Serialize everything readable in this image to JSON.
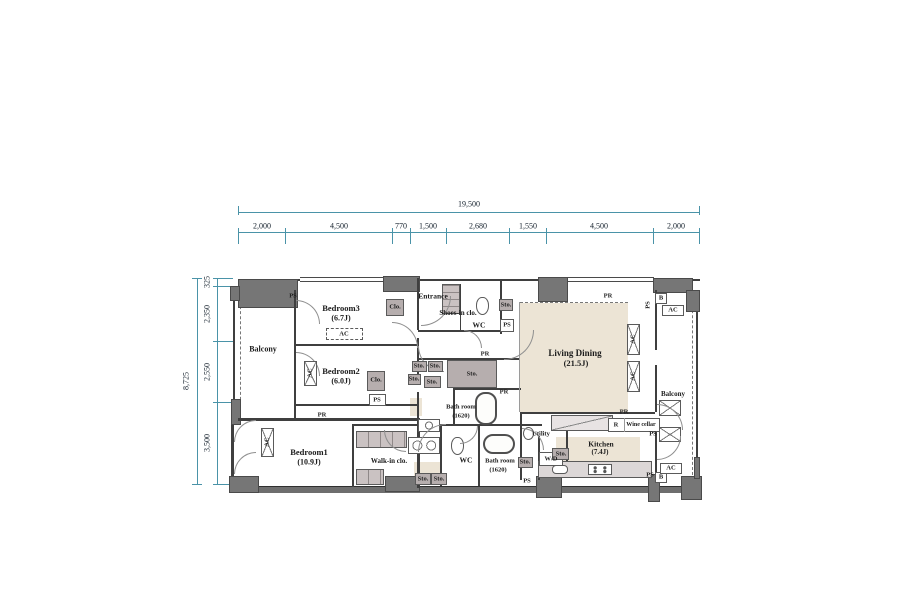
{
  "dim_top": {
    "total": "19,500",
    "segments": [
      "2,000",
      "4,500",
      "770",
      "1,500",
      "2,680",
      "1,550",
      "4,500",
      "2,000"
    ]
  },
  "dim_left": {
    "total": "8,725",
    "segments": [
      "325",
      "2,350",
      "2,550",
      "3,500"
    ]
  },
  "rooms": {
    "balcony_left": "Balcony",
    "balcony_right": "Balcony",
    "bedroom3_name": "Bedroom3",
    "bedroom3_size": "(6.7J)",
    "bedroom2_name": "Bedroom2",
    "bedroom2_size": "(6.0J)",
    "bedroom1_name": "Bedroom1",
    "bedroom1_size": "(10.9J)",
    "walk_in_clo": "Walk-in clo.",
    "entrance": "Entrance",
    "shoes_in_clo": "Shoes-in clo.",
    "wc": "WC",
    "bath_name": "Bath room",
    "bath_size": "(1620)",
    "living_name": "Living Dining",
    "living_size": "(21.5J)",
    "kitchen_name": "Kitchen",
    "kitchen_size": "(7.4J)",
    "utility": "Utility",
    "wine_cellar": "Wine cellar"
  },
  "tags": {
    "ac": "AC",
    "ps": "PS",
    "pr": "PR",
    "sto": "Sto.",
    "clo": "Clo.",
    "wd": "W/D",
    "b": "B",
    "r": "R"
  }
}
